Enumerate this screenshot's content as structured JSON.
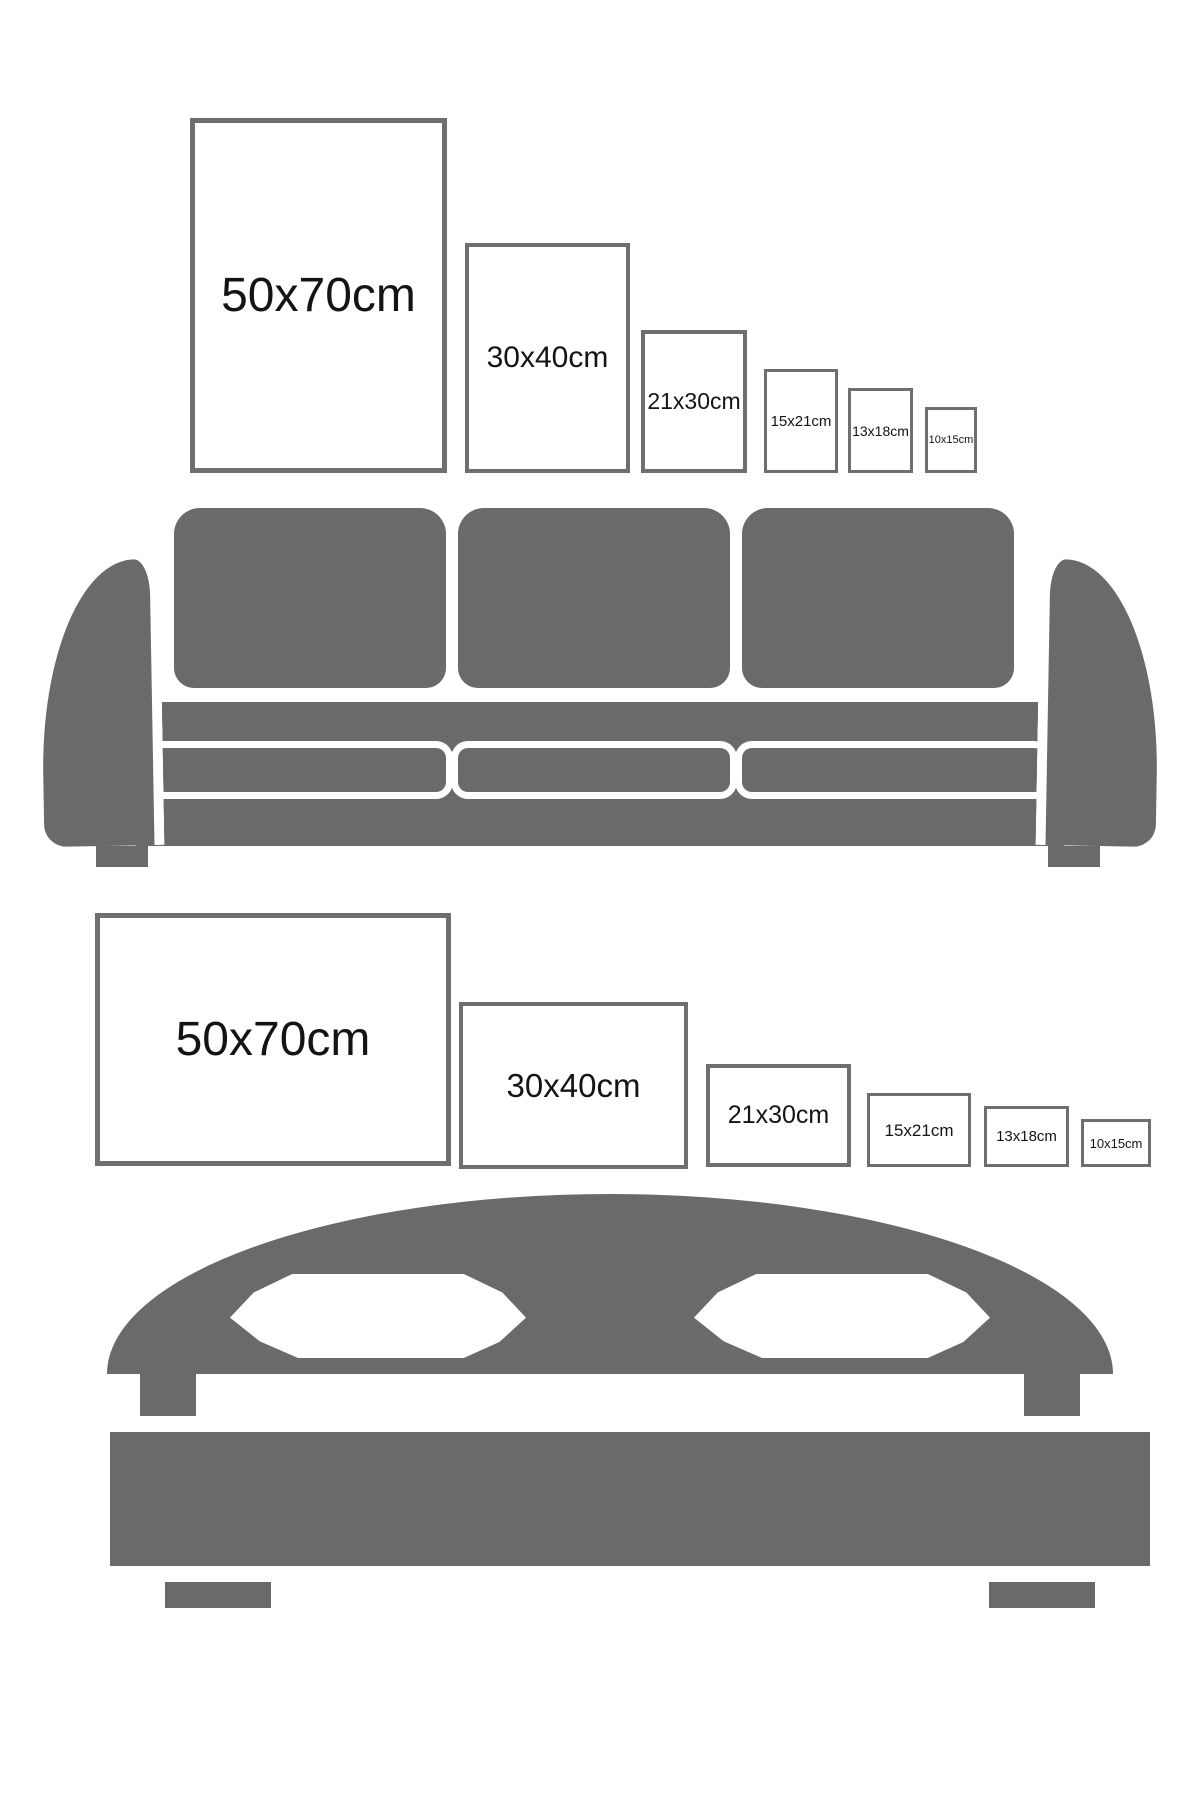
{
  "colors": {
    "furniture": "#6a6a6a",
    "outline": "#ffffff",
    "frame-border": "#6f6f6f",
    "label-text": "#141414"
  },
  "sections": [
    {
      "id": "sofa-sizes",
      "furniture": "sofa",
      "orientation": "portrait",
      "frames": [
        {
          "label": "50x70cm",
          "x": 190,
          "y": 118,
          "w": 257,
          "h": 355,
          "border": 5,
          "font": 48
        },
        {
          "label": "30x40cm",
          "x": 465,
          "y": 243,
          "w": 165,
          "h": 230,
          "border": 4,
          "font": 30
        },
        {
          "label": "21x30cm",
          "x": 641,
          "y": 330,
          "w": 106,
          "h": 143,
          "border": 4,
          "font": 23
        },
        {
          "label": "15x21cm",
          "x": 764,
          "y": 369,
          "w": 74,
          "h": 104,
          "border": 3,
          "font": 15
        },
        {
          "label": "13x18cm",
          "x": 848,
          "y": 388,
          "w": 65,
          "h": 85,
          "border": 3,
          "font": 14
        },
        {
          "label": "10x15cm",
          "x": 925,
          "y": 407,
          "w": 52,
          "h": 66,
          "border": 3,
          "font": 11
        }
      ]
    },
    {
      "id": "bed-sizes",
      "furniture": "bed",
      "orientation": "landscape",
      "frames": [
        {
          "label": "50x70cm",
          "x": 95,
          "y": 913,
          "w": 356,
          "h": 253,
          "border": 5,
          "font": 48
        },
        {
          "label": "30x40cm",
          "x": 459,
          "y": 1002,
          "w": 229,
          "h": 167,
          "border": 4,
          "font": 33
        },
        {
          "label": "21x30cm",
          "x": 706,
          "y": 1064,
          "w": 145,
          "h": 103,
          "border": 4,
          "font": 25
        },
        {
          "label": "15x21cm",
          "x": 867,
          "y": 1093,
          "w": 104,
          "h": 74,
          "border": 3,
          "font": 17
        },
        {
          "label": "13x18cm",
          "x": 984,
          "y": 1106,
          "w": 85,
          "h": 61,
          "border": 3,
          "font": 15
        },
        {
          "label": "10x15cm",
          "x": 1081,
          "y": 1119,
          "w": 70,
          "h": 48,
          "border": 3,
          "font": 13
        }
      ]
    }
  ]
}
